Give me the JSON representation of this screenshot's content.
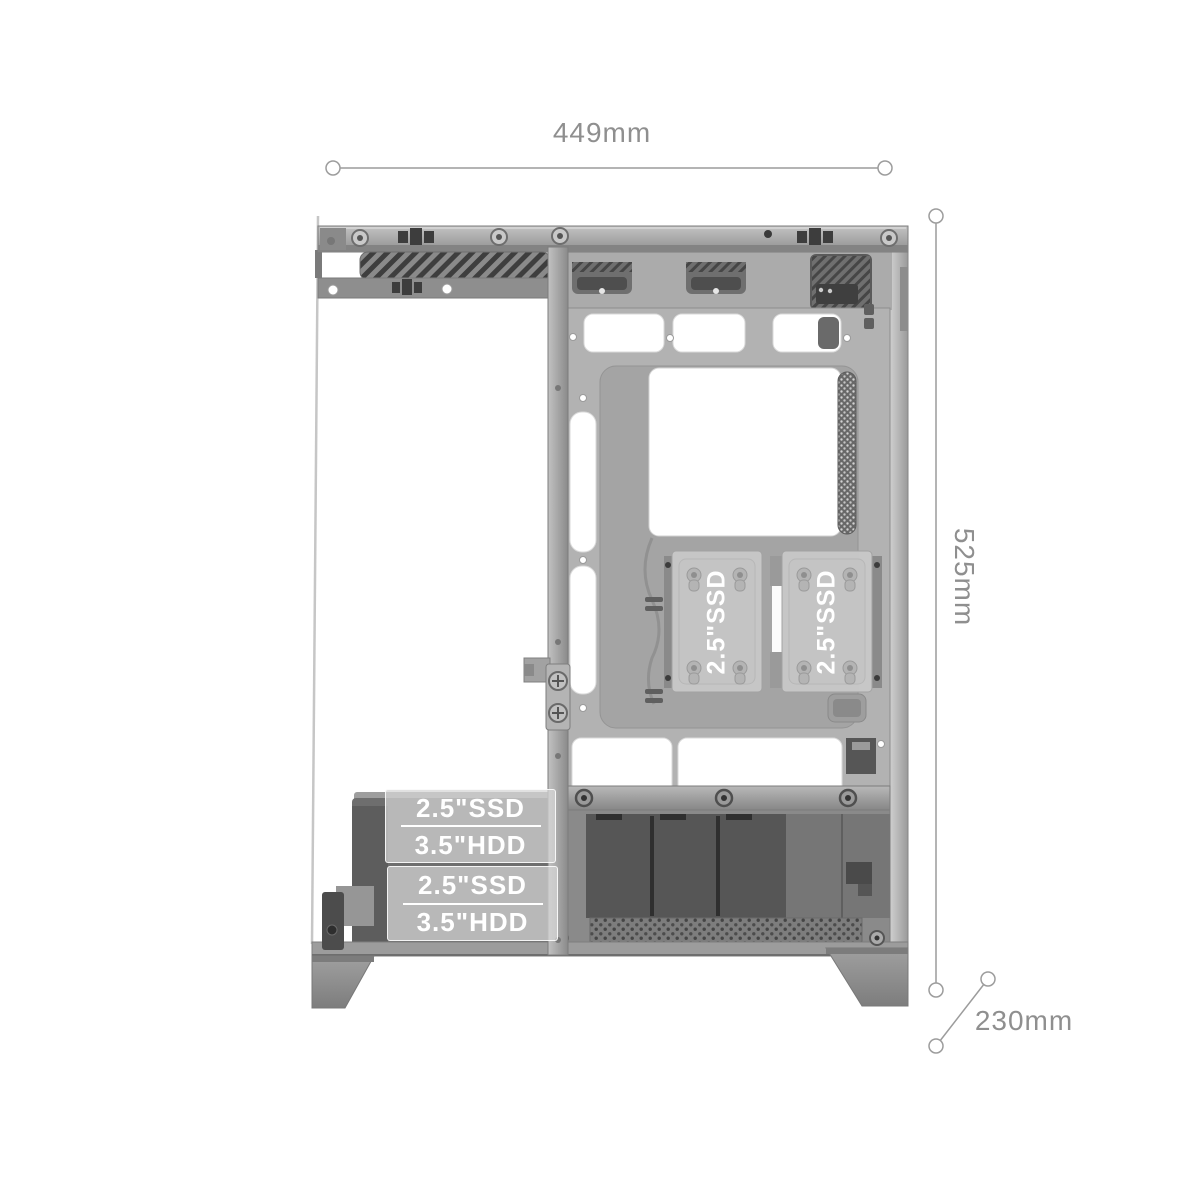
{
  "annotations": {
    "width_label": "449mm",
    "height_label": "525mm",
    "depth_label": "230mm"
  },
  "ssd_mounts": [
    {
      "label": "2.5\"SSD"
    },
    {
      "label": "2.5\"SSD"
    }
  ],
  "drive_bays": [
    {
      "ssd_label": "2.5\"SSD",
      "hdd_label": "3.5\"HDD"
    },
    {
      "ssd_label": "2.5\"SSD",
      "hdd_label": "3.5\"HDD"
    }
  ],
  "colors": {
    "annotation": "#9c9c9c",
    "label_text": "#ffffff",
    "background": "#ffffff"
  }
}
